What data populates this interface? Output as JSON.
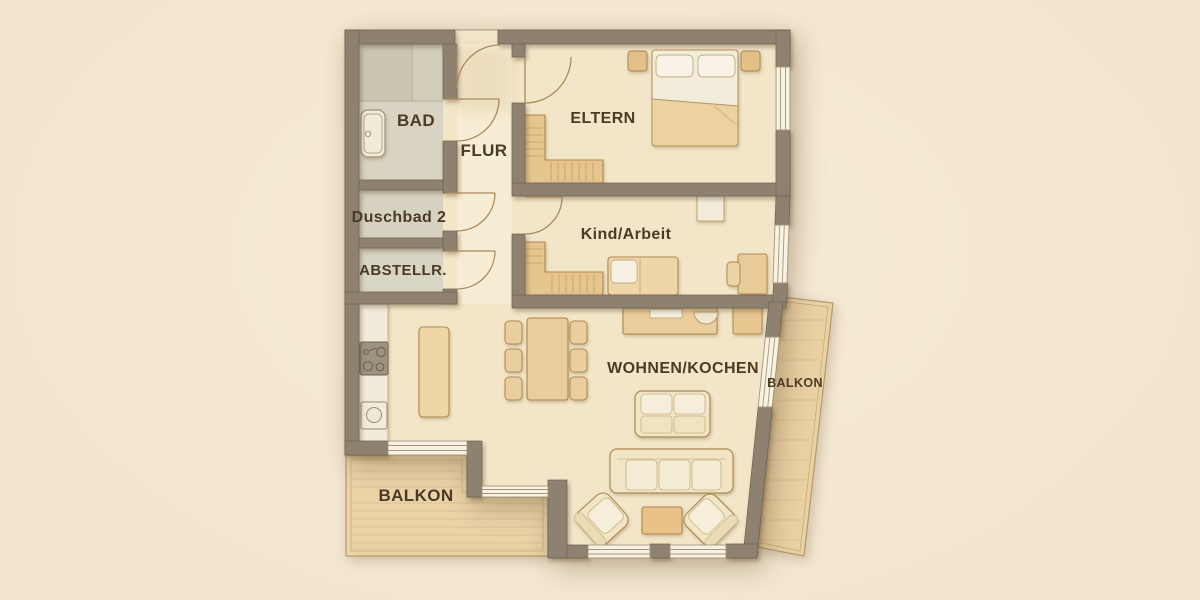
{
  "plan": {
    "type": "apartment-floor-plan",
    "rooms": {
      "bad": {
        "label": "BAD"
      },
      "duschbad": {
        "label": "Duschbad 2"
      },
      "abstellraum": {
        "label": "ABSTELLR."
      },
      "flur": {
        "label": "FLUR"
      },
      "eltern": {
        "label": "ELTERN"
      },
      "kind_arbeit": {
        "label": "Kind/Arbeit"
      },
      "wohnen_kochen": {
        "label": "WOHNEN/KOCHEN"
      },
      "balkon_sued": {
        "label": "BALKON"
      },
      "balkon_ost": {
        "label": "BALKON"
      }
    },
    "palette": {
      "background": "#f1e4cd",
      "floor": "#f3e6c8",
      "flur_floor": "#f8efd9",
      "wall": "#8e8170",
      "wall_outline": "#6e6250",
      "tile": "#d8d4c1",
      "shower_tile": "#cac6b2",
      "balcony_deck": "#ebd3a8",
      "wood_furniture": "#e9cd9b",
      "upholstery": "#f1e5c5",
      "linen": "#f7f1e2",
      "window": "#f8f2e2",
      "label_text": "#4b3a25",
      "door_arc": "#a8895a"
    },
    "furniture_icons": [
      "bathtub-icon",
      "shower-icon",
      "cooktop-icon",
      "sink-icon",
      "kitchen-counter",
      "kitchen-island",
      "dining-table",
      "dining-chair",
      "double-bed",
      "pillow",
      "nightstand",
      "wardrobe",
      "single-bed",
      "desk",
      "desk-chair",
      "side-table",
      "sideboard",
      "laptop",
      "cabinet",
      "loveseat",
      "sofa",
      "coffee-table",
      "armchair",
      "door-swing",
      "window",
      "balcony-deck"
    ]
  }
}
